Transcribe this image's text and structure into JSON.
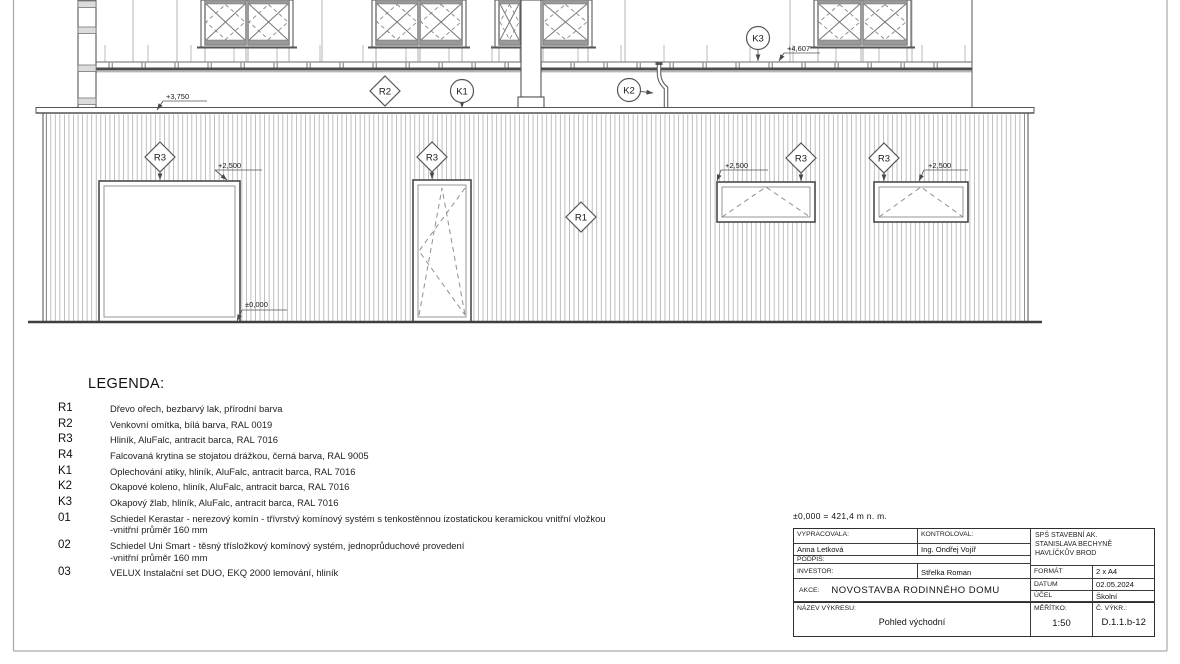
{
  "sheet": {
    "scale_note": "±0,000 = 421,4 m n. m."
  },
  "legend": {
    "title": "LEGENDA:",
    "items": [
      {
        "code": "R1",
        "text": "Dřevo ořech, bezbarvý lak, přírodní barva"
      },
      {
        "code": "R2",
        "text": "Venkovní omítka, bílá barva, RAL 0019"
      },
      {
        "code": "R3",
        "text": "Hliník, AluFalc, antracit barca, RAL 7016"
      },
      {
        "code": "R4",
        "text": "Falcovaná krytina se stojatou drážkou, černá barva, RAL 9005"
      },
      {
        "code": "K1",
        "text": "Oplechování atiky, hliník, AluFalc, antracit barca, RAL 7016"
      },
      {
        "code": "K2",
        "text": "Okapové koleno, hliník, AluFalc, antracit barca, RAL 7016"
      },
      {
        "code": "K3",
        "text": "Okapový žlab, hliník, AluFalc, antracit barca, RAL 7016"
      },
      {
        "code": "01",
        "text": "Schiedel Kerastar - nerezový komín - třívrstvý komínový systém s tenkostěnnou izostatickou keramickou vnitřní vložkou\n-vnitřní průměr 160 mm"
      },
      {
        "code": "02",
        "text": "Schiedel Uni Smart - těsný třísložkový komínový systém, jednoprůduchové provedení\n-vnitřní průměr 160 mm"
      },
      {
        "code": "03",
        "text": "VELUX Instalační set DUO, EKQ 2000 lemování, hliník"
      }
    ]
  },
  "title_block": {
    "vypracovala_label": "VYPRACOVALA:",
    "vypracovala": "Anna Letková",
    "kontroloval_label": "KONTROLOVAL:",
    "kontroloval": "Ing. Ondřej Vojíř",
    "podpis_label": "PODPIS:",
    "investor_label": "INVESTOR:",
    "investor": "Střelka Roman",
    "akce_label": "AKCE:",
    "akce": "NOVOSTAVBA RODINNÉHO DOMU",
    "nazev_label": "NÁZEV VÝKRESU:",
    "nazev": "Pohled východní",
    "school": "SPŠ STAVEBNÍ AK.\nSTANISLAVA BECHYNĚ\nHAVLÍČKŮV BROD",
    "format_label": "FORMÁT",
    "format": "2 x A4",
    "datum_label": "DATUM",
    "datum": "02.05.2024",
    "ucel_label": "ÚČEL",
    "ucel": "Školní",
    "meritko_label": "MĚŘÍTKO:",
    "meritko": "1:50",
    "cvykr_label": "Č. VÝKR.:",
    "cvykr": "D.1.1.b-12"
  },
  "elevation": {
    "colors": {
      "line": "#555555",
      "dark": "#3f3f3f",
      "hatch": "#b4b4b4",
      "sash_fill": "#999999",
      "text": "#1a1a1a"
    },
    "markers": [
      {
        "shape": "diamond",
        "label": "R2",
        "cx": 385,
        "cy": 91
      },
      {
        "shape": "circle",
        "label": "K1",
        "cx": 462,
        "cy": 91,
        "arrow": [
          462,
          108
        ]
      },
      {
        "shape": "circle",
        "label": "K2",
        "cx": 629,
        "cy": 90,
        "arrow": [
          653,
          93
        ]
      },
      {
        "shape": "circle",
        "label": "K3",
        "cx": 758,
        "cy": 38,
        "arrow": [
          758,
          61
        ]
      },
      {
        "shape": "diamond",
        "label": "R3",
        "cx": 160,
        "cy": 157,
        "arrow": [
          160,
          180
        ]
      },
      {
        "shape": "diamond",
        "label": "R3",
        "cx": 432,
        "cy": 157,
        "arrow": [
          432,
          179
        ]
      },
      {
        "shape": "diamond",
        "label": "R1",
        "cx": 581,
        "cy": 217
      },
      {
        "shape": "diamond",
        "label": "R3",
        "cx": 801,
        "cy": 158,
        "arrow": [
          801,
          181
        ]
      },
      {
        "shape": "diamond",
        "label": "R3",
        "cx": 884,
        "cy": 158,
        "arrow": [
          884,
          181
        ]
      }
    ],
    "levels": [
      {
        "text": "+3,750",
        "tx": 166,
        "ty": 99,
        "ux1": 163,
        "ux2": 207,
        "uy": 101,
        "ax": 157,
        "ay": 110
      },
      {
        "text": "+4,607",
        "tx": 787,
        "ty": 51,
        "ux1": 784,
        "ux2": 820,
        "uy": 53,
        "ax": 779,
        "ay": 61
      },
      {
        "text": "+2,500",
        "tx": 218,
        "ty": 168,
        "ux1": 215,
        "ux2": 262,
        "uy": 170,
        "ax": 227,
        "ay": 180
      },
      {
        "text": "+2,500",
        "tx": 725,
        "ty": 168,
        "ux1": 721,
        "ux2": 768,
        "uy": 170,
        "ax": 717,
        "ay": 181
      },
      {
        "text": "+2,500",
        "tx": 928,
        "ty": 168,
        "ux1": 924,
        "ux2": 968,
        "uy": 170,
        "ax": 919,
        "ay": 181
      },
      {
        "text": "±0,000",
        "tx": 245,
        "ty": 307,
        "ux1": 242,
        "ux2": 287,
        "uy": 310,
        "ax": 237,
        "ay": 321
      }
    ],
    "upper_window_groups": [
      {
        "x": 203,
        "w": 88,
        "sashes": [
          [
            205,
            41
          ],
          [
            248,
            41
          ]
        ]
      },
      {
        "x": 374,
        "w": 90,
        "sashes": [
          [
            376,
            42
          ],
          [
            420,
            42
          ]
        ]
      },
      {
        "x": 497,
        "w": 93,
        "sashes": [
          [
            499,
            21
          ],
          [
            543,
            45
          ]
        ]
      },
      {
        "x": 816,
        "w": 93,
        "sashes": [
          [
            818,
            43
          ],
          [
            863,
            44
          ]
        ]
      }
    ],
    "lower_openings": [
      {
        "type": "plain",
        "x": 99,
        "y": 181,
        "w": 141,
        "h": 141
      },
      {
        "type": "tiltturn",
        "x": 413,
        "y": 180,
        "w": 58,
        "h": 142
      },
      {
        "type": "tilt",
        "x": 717,
        "y": 182,
        "w": 98,
        "h": 40
      },
      {
        "type": "tilt",
        "x": 874,
        "y": 182,
        "w": 94,
        "h": 40
      }
    ]
  }
}
